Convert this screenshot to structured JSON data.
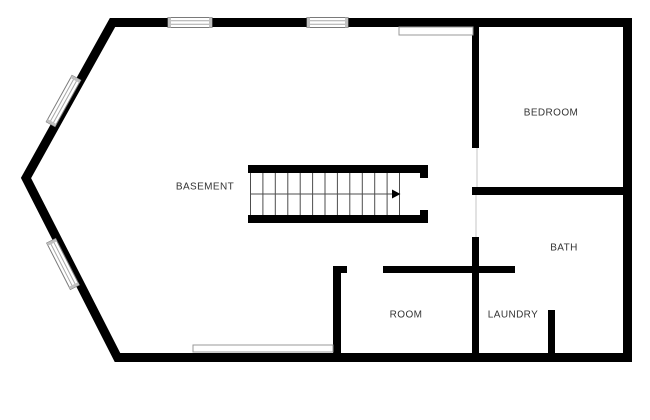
{
  "plan": {
    "name": "basement-floor-plan",
    "labels": {
      "basement": "BASEMENT",
      "bedroom": "BEDROOM",
      "bath": "BATH",
      "laundry": "LAUNDRY",
      "room": "ROOM"
    },
    "colors": {
      "wall": "#000000",
      "label_text": "#333333",
      "window_outline": "#7a7a7a",
      "window_inner_line": "#a8a8a8",
      "window_end_cap": "#c0c0c0",
      "opening_outline": "#999999",
      "tread_line": "#4d4d4d",
      "door_threshold": "#d8d8d8",
      "background": "#ffffff"
    },
    "icons": {
      "stair_arrow": "right-direction-arrow"
    }
  }
}
